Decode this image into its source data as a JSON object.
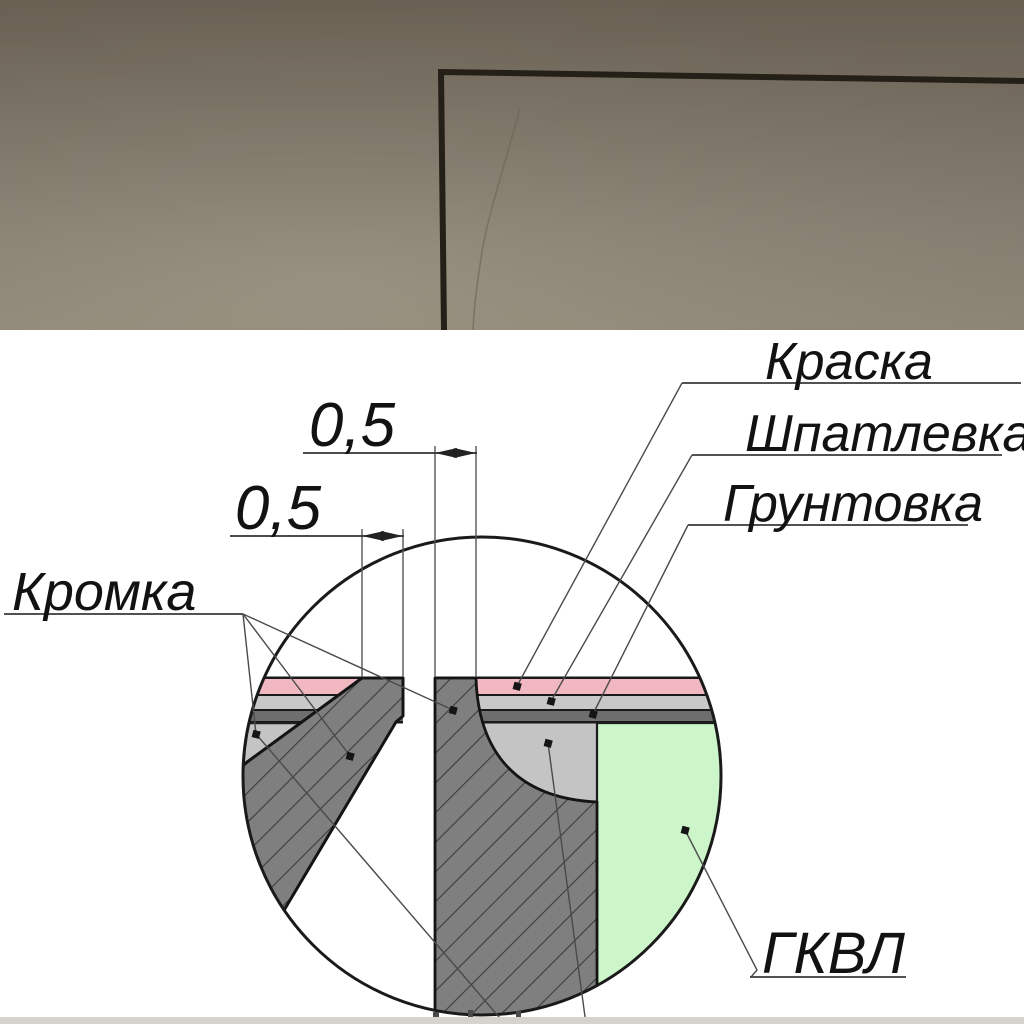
{
  "diagram": {
    "labels": {
      "paint": "Краска",
      "putty": "Шпатлевка",
      "primer": "Грунтовка",
      "edge": "Кромка",
      "board": "ГКВЛ"
    },
    "dimensions": {
      "gap_top": "0,5",
      "gap_left": "0,5"
    },
    "colors": {
      "paint_layer": "#F2B8C1",
      "putty_layer": "#C8C8C8",
      "primer_layer": "#6E6E6E",
      "putty_fill": "#C4C4C4",
      "board_section_fill": "#7F7F7F",
      "board_face_fill": "#CDF5CA"
    }
  }
}
